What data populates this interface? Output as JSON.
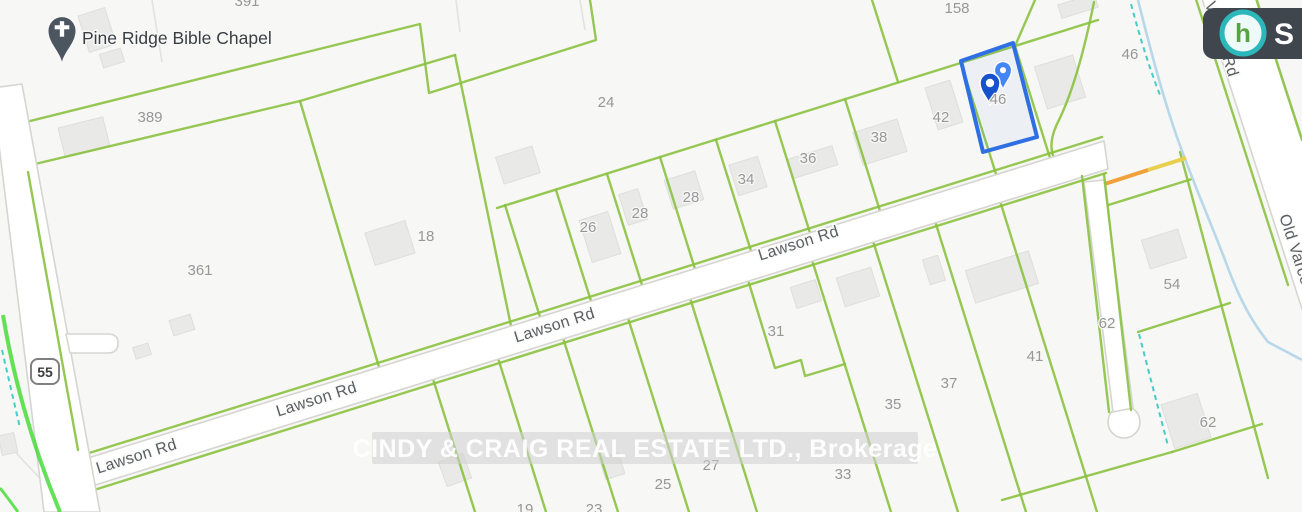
{
  "poi": {
    "name": "Pine Ridge Bible Chapel"
  },
  "watermark": {
    "text": "CINDY & CRAIG REAL ESTATE LTD., Brokerage"
  },
  "route_shield": {
    "number": "55"
  },
  "brand_badge": {
    "letter": "S",
    "logo_glyph": "h"
  },
  "selected_lot": {
    "number": "46"
  },
  "road_labels": [
    {
      "name": "Lawson Rd",
      "x": 138,
      "y": 461,
      "rot": -17.5
    },
    {
      "name": "Lawson Rd",
      "x": 318,
      "y": 404,
      "rot": -17.5
    },
    {
      "name": "Lawson Rd",
      "x": 556,
      "y": 330,
      "rot": -17.5
    },
    {
      "name": "Lawson Rd",
      "x": 800,
      "y": 248,
      "rot": -17.5
    },
    {
      "name": "Old Varcoe Rd",
      "x": 1212,
      "y": 26,
      "rot": 72
    },
    {
      "name": "Old Varcoe Rd",
      "x": 1296,
      "y": 268,
      "rot": 72
    }
  ],
  "lot_labels": [
    {
      "number": "391",
      "x": 247,
      "y": 6
    },
    {
      "number": "158",
      "x": 957,
      "y": 13
    },
    {
      "number": "389",
      "x": 150,
      "y": 122
    },
    {
      "number": "361",
      "x": 200,
      "y": 275
    },
    {
      "number": "18",
      "x": 426,
      "y": 241
    },
    {
      "number": "24",
      "x": 606,
      "y": 107
    },
    {
      "number": "26",
      "x": 588,
      "y": 232
    },
    {
      "number": "28",
      "x": 640,
      "y": 218
    },
    {
      "number": "28",
      "x": 691,
      "y": 202
    },
    {
      "number": "34",
      "x": 746,
      "y": 184
    },
    {
      "number": "36",
      "x": 808,
      "y": 163
    },
    {
      "number": "38",
      "x": 879,
      "y": 142
    },
    {
      "number": "42",
      "x": 941,
      "y": 122
    },
    {
      "number": "46",
      "x": 998,
      "y": 104
    },
    {
      "number": "46",
      "x": 1130,
      "y": 59
    },
    {
      "number": "19",
      "x": 525,
      "y": 514
    },
    {
      "number": "23",
      "x": 594,
      "y": 514
    },
    {
      "number": "25",
      "x": 663,
      "y": 489
    },
    {
      "number": "27",
      "x": 711,
      "y": 470
    },
    {
      "number": "31",
      "x": 776,
      "y": 336
    },
    {
      "number": "33",
      "x": 843,
      "y": 479
    },
    {
      "number": "35",
      "x": 893,
      "y": 409
    },
    {
      "number": "37",
      "x": 949,
      "y": 388
    },
    {
      "number": "41",
      "x": 1035,
      "y": 361
    },
    {
      "number": "54",
      "x": 1172,
      "y": 289
    },
    {
      "number": "62",
      "x": 1107,
      "y": 328
    },
    {
      "number": "62",
      "x": 1208,
      "y": 427
    }
  ],
  "colors": {
    "parcel_line": "#8ac140",
    "highlight_blue": "#2f6fe4",
    "stream_blue": "#b8d8ea",
    "boundary_teal": "#34c8c0",
    "construction_orange": "#f0a13c",
    "bright_edge_green": "#3fd92f"
  }
}
